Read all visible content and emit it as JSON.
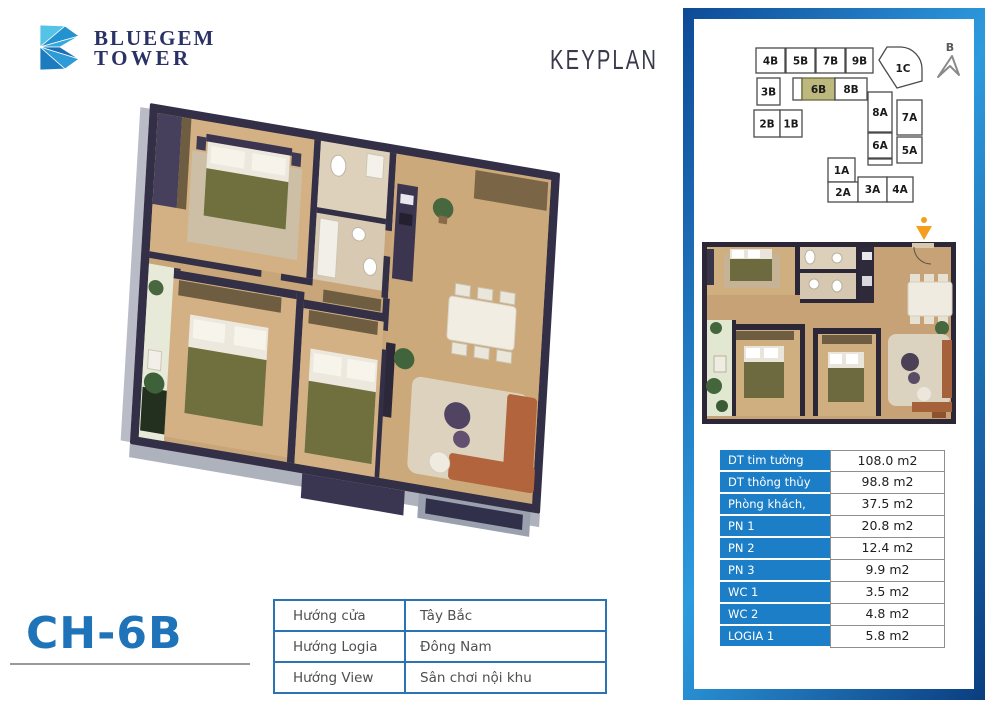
{
  "brand": {
    "line1": "BLUEGEM",
    "line2": "TOWER",
    "navy": "#2a3166",
    "blue": "#2d9ade"
  },
  "header": {
    "keyplan": "KEYPLAN"
  },
  "unit": {
    "code": "CH-6B",
    "accent_blue": "#1f74b9"
  },
  "keyplan": {
    "compass": "B",
    "highlight_color": "#bdb97e",
    "highlighted_unit": "6B",
    "units": [
      {
        "label": "4B"
      },
      {
        "label": "5B"
      },
      {
        "label": "7B"
      },
      {
        "label": "9B"
      },
      {
        "label": "1C"
      },
      {
        "label": "3B"
      },
      {
        "label": "6B"
      },
      {
        "label": "8B"
      },
      {
        "label": "2B"
      },
      {
        "label": "1B"
      },
      {
        "label": "8A"
      },
      {
        "label": "7A"
      },
      {
        "label": "6A"
      },
      {
        "label": "5A"
      },
      {
        "label": "1A"
      },
      {
        "label": "2A"
      },
      {
        "label": "3A"
      },
      {
        "label": "4A"
      }
    ]
  },
  "area_table": {
    "label_bg": "#1c7ec6",
    "rows": [
      {
        "label": "DT tim tường",
        "value": "108.0 m2"
      },
      {
        "label": "DT thông thủy",
        "value": "98.8 m2"
      },
      {
        "label": "Phòng khách, bếp",
        "value": "37.5 m2"
      },
      {
        "label": "PN 1",
        "value": "20.8 m2"
      },
      {
        "label": "PN 2",
        "value": "12.4 m2"
      },
      {
        "label": "PN 3",
        "value": "9.9 m2"
      },
      {
        "label": "WC 1",
        "value": "3.5 m2"
      },
      {
        "label": "WC 2",
        "value": "4.8 m2"
      },
      {
        "label": "LOGIA 1",
        "value": "5.8 m2"
      }
    ]
  },
  "orientation_table": {
    "rows": [
      {
        "label": "Hướng cửa",
        "value": "Tây Bắc"
      },
      {
        "label": "Hướng Logia",
        "value": "Đông Nam"
      },
      {
        "label": "Hướng View",
        "value": "Sân chơi nội khu"
      }
    ]
  },
  "floorplan": {
    "entrance_arrow_color": "#f59d1f",
    "wall_color": "#332f47",
    "floor_wood": "#cba97b"
  }
}
